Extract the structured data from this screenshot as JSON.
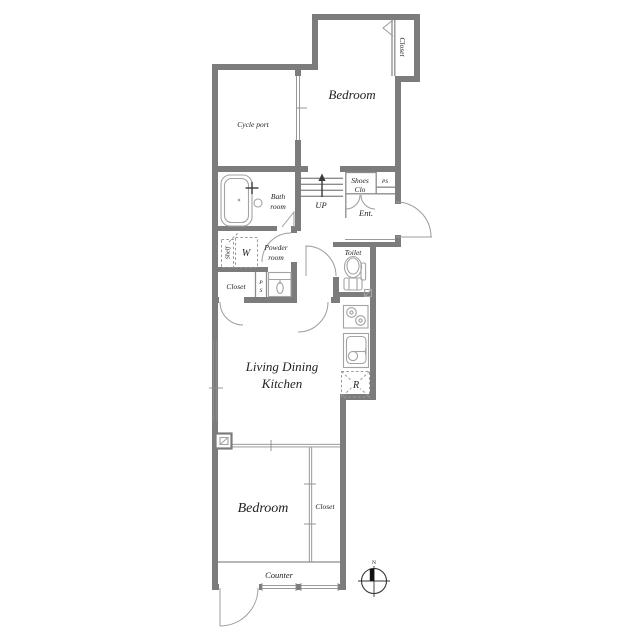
{
  "floorplan": {
    "title": "apartment-floor-plan",
    "labels": {
      "closet_top": "Closet",
      "bedroom_top": "Bedroom",
      "cycle_port": "Cycle port",
      "bath_line1": "Bath",
      "bath_line2": "room",
      "up": "UP",
      "shoes_line1": "Shoes",
      "shoes_line2": "Clo",
      "ps_entry": "PS",
      "ent": "Ent.",
      "shelf": "Shelf",
      "washer": "W",
      "powder_line1": "Powder",
      "powder_line2": "room",
      "closet_mid": "Closet",
      "ps_mid_p": "P",
      "ps_mid_s": "S",
      "toilet": "Toilet",
      "ldk_line1": "Living Dining",
      "ldk_line2": "Kitchen",
      "fridge": "R",
      "bedroom_bottom": "Bedroom",
      "closet_bottom": "Closet",
      "counter": "Counter",
      "compass_north": "N"
    },
    "colors": {
      "wall": "#7c7c7c",
      "line": "#8c8c8c",
      "fixture": "#a3a3a3",
      "text": "#222222"
    }
  }
}
